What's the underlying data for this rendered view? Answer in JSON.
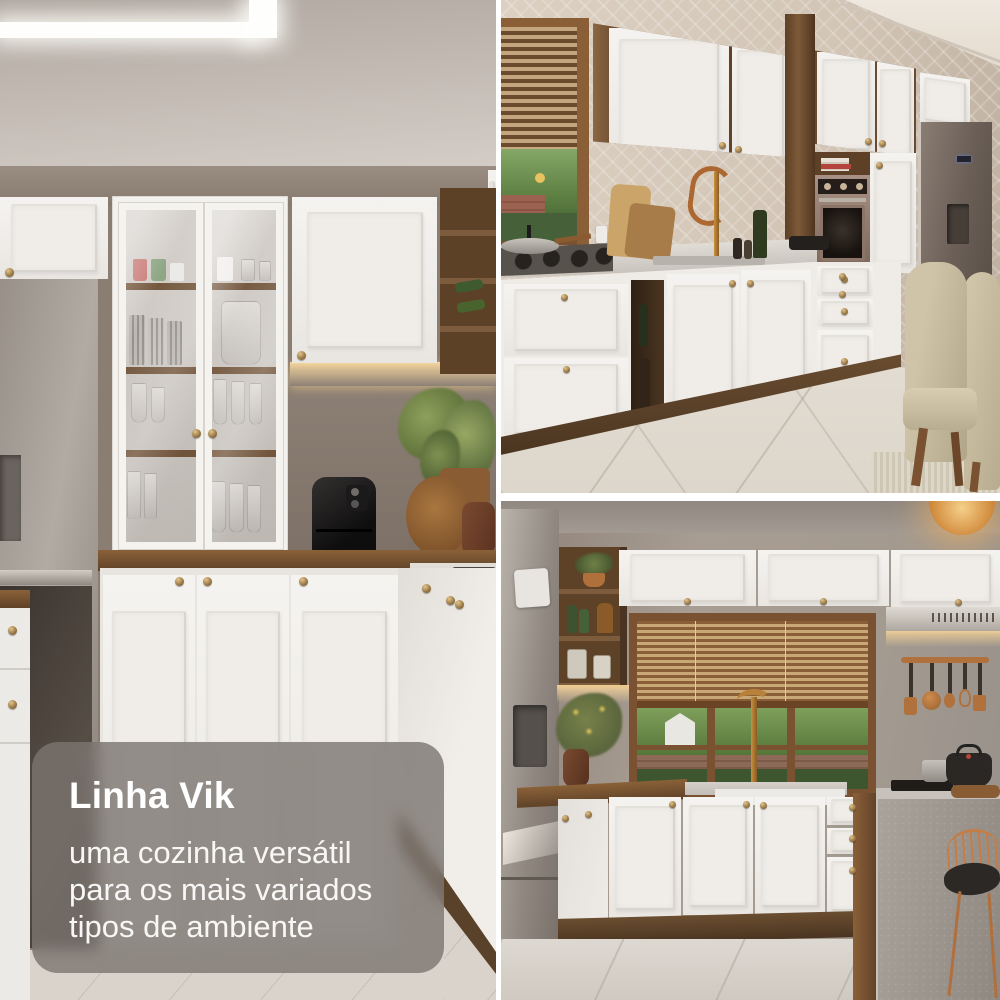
{
  "caption": {
    "title": "Linha Vik",
    "subtitle": "uma cozinha versátil para os mais variados tipos de ambiente",
    "subtitle_lines": [
      "uma cozinha versátil",
      "para os mais variados",
      "tipos de ambiente"
    ]
  },
  "photos": {
    "left": {
      "alt": "kitchen with glass-door hutch, stainless fridge, air fryer and white cabinets"
    },
    "top_right": {
      "alt": "kitchen run with window, gas cooktop, built-in oven, fridge and dining chairs"
    },
    "bottom_right": {
      "alt": "kitchen with wood-blind window, hanging copper utensils, island and copper stool"
    }
  },
  "colors": {
    "overlay_bg": "#7a746f",
    "text": "#ffffff",
    "cabinet_white": "#f2efeb",
    "wood_brown": "#6e4f33",
    "wall_taupe": "#8a7d72",
    "backsplash_beige": "#d8ccbf",
    "counter_gray": "#cdc8c1",
    "floor_beige": "#d9d3cb",
    "copper": "#b06a3a",
    "led_glow": "#f0c386",
    "steel": "#a9a29a"
  }
}
